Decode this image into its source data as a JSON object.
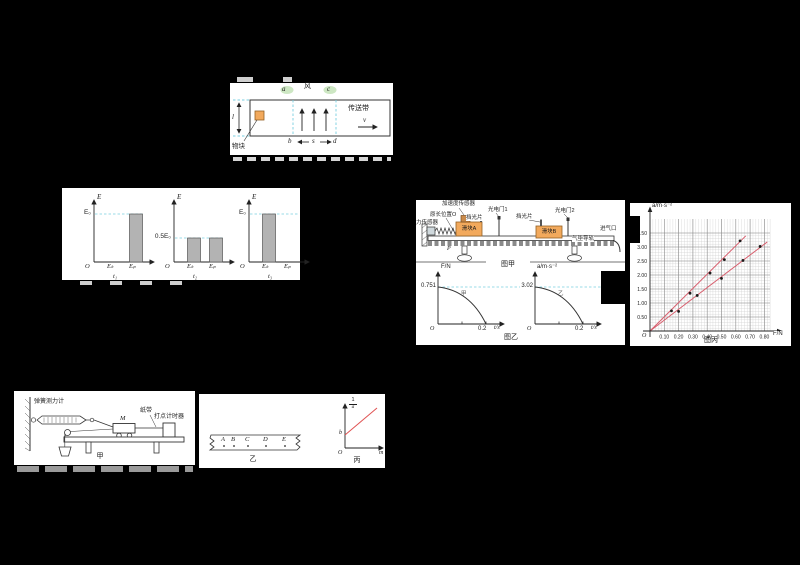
{
  "page": {
    "background": "#000000",
    "paper": "#ffffff"
  },
  "colors": {
    "dashed_cyan": "#79cfe0",
    "line_red": "#d85f6e",
    "line_red_bright": "#e05252",
    "block_orange": "#f2a95c",
    "bar_gray": "#b3b3b3",
    "green_marker": "#cde7c3"
  },
  "conveyor": {
    "block": "物块",
    "wind": "风",
    "belt": "传送带",
    "v": "v",
    "l": "l",
    "a": "a",
    "b": "b",
    "c": "c",
    "d": "d",
    "s": "s"
  },
  "energy": {
    "axis": "E",
    "origin": "O",
    "ek": "Eₖ",
    "ep": "Eₚ",
    "charts": [
      {
        "ref": "E₀",
        "t": "t₁"
      },
      {
        "ref": "0.5E₀",
        "t": "t₂"
      },
      {
        "ref": "E₀",
        "t": "t₃"
      }
    ]
  },
  "airtrack": {
    "force_sensor": "力传感器",
    "natural_pos": "原长位置O",
    "accel_sensor": "加速度传感器",
    "shutter1": "挡光片",
    "shutter2": "挡光片",
    "gate1": "光电门1",
    "gate2": "光电门2",
    "slider_a": "滑块A",
    "slider_b": "滑块B",
    "p": "P",
    "track": "气垫导轨",
    "inlet": "进气口",
    "caption": "图甲"
  },
  "sensor_graphs": {
    "caption": "图乙",
    "f": {
      "ylabel": "F/N",
      "ref": "0.751",
      "xtick": "0.2",
      "xlabel": "t/s",
      "o": "O",
      "tag": "甲"
    },
    "a": {
      "ylabel": "a/m·s⁻²",
      "ref": "3.02",
      "xtick": "0.2",
      "xlabel": "t/s",
      "o": "O",
      "tag": "乙"
    }
  },
  "grid_chart": {
    "ylabel": "a/m·s⁻²",
    "xlabel": "F/N",
    "o": "O",
    "caption": "图丙"
  },
  "cart_setup": {
    "spring_scale": "弹簧测力计",
    "m": "M",
    "tape": "纸带",
    "timer": "打点计时器",
    "caption": "甲"
  },
  "tape": {
    "points": [
      "A",
      "B",
      "C",
      "D",
      "E"
    ],
    "caption": "乙"
  },
  "inverse_graph": {
    "num": "1",
    "den": "a",
    "b": "b",
    "o": "O",
    "xlabel": "m",
    "caption": "丙"
  },
  "chart_data": [
    {
      "type": "bar",
      "ylabel": "E",
      "categories": [
        "Eₖ",
        "Eₚ"
      ],
      "unit": "E₀",
      "series": [
        {
          "name": "t₁",
          "values": [
            0,
            1
          ],
          "ref_line": 1
        },
        {
          "name": "t₂",
          "values": [
            0.5,
            0.5
          ],
          "ref_line": 0.5
        },
        {
          "name": "t₃",
          "values": [
            1,
            0
          ],
          "ref_line": 1
        }
      ]
    },
    {
      "type": "line",
      "ylabel": "F/N",
      "xlabel": "t/s",
      "y_intercept": 0.751,
      "x_intercept": 0.2,
      "shape": "concave decreasing curve"
    },
    {
      "type": "line",
      "ylabel": "a/m·s⁻²",
      "xlabel": "t/s",
      "y_intercept": 3.02,
      "x_intercept": 0.2,
      "shape": "concave decreasing curve"
    },
    {
      "type": "scatter",
      "xlabel": "F/N",
      "ylabel": "a/m·s⁻²",
      "xlim": [
        0,
        0.85
      ],
      "ylim": [
        0,
        3.6
      ],
      "xticks": [
        "0.10",
        "0.20",
        "0.30",
        "0.40",
        "0.50",
        "0.60",
        "0.70",
        "0.80"
      ],
      "yticks": [
        "0.50",
        "1.00",
        "1.50",
        "2.00",
        "2.50",
        "3.00",
        "3.50"
      ],
      "grid": "fine graph paper",
      "series": [
        {
          "name": "upper",
          "points": [
            [
              0.15,
              0.72
            ],
            [
              0.28,
              1.35
            ],
            [
              0.42,
              2.07
            ],
            [
              0.52,
              2.55
            ],
            [
              0.63,
              3.22
            ]
          ],
          "fit_from": [
            0,
            0
          ],
          "fit_to": [
            0.67,
            3.4
          ]
        },
        {
          "name": "lower",
          "points": [
            [
              0.2,
              0.7
            ],
            [
              0.33,
              1.27
            ],
            [
              0.5,
              1.88
            ],
            [
              0.65,
              2.52
            ],
            [
              0.77,
              3.02
            ]
          ],
          "fit_from": [
            0,
            0
          ],
          "fit_to": [
            0.82,
            3.18
          ]
        }
      ]
    },
    {
      "type": "line",
      "ylabel": "1/a",
      "xlabel": "m",
      "y_intercept": "b",
      "shape": "straight increasing"
    }
  ]
}
